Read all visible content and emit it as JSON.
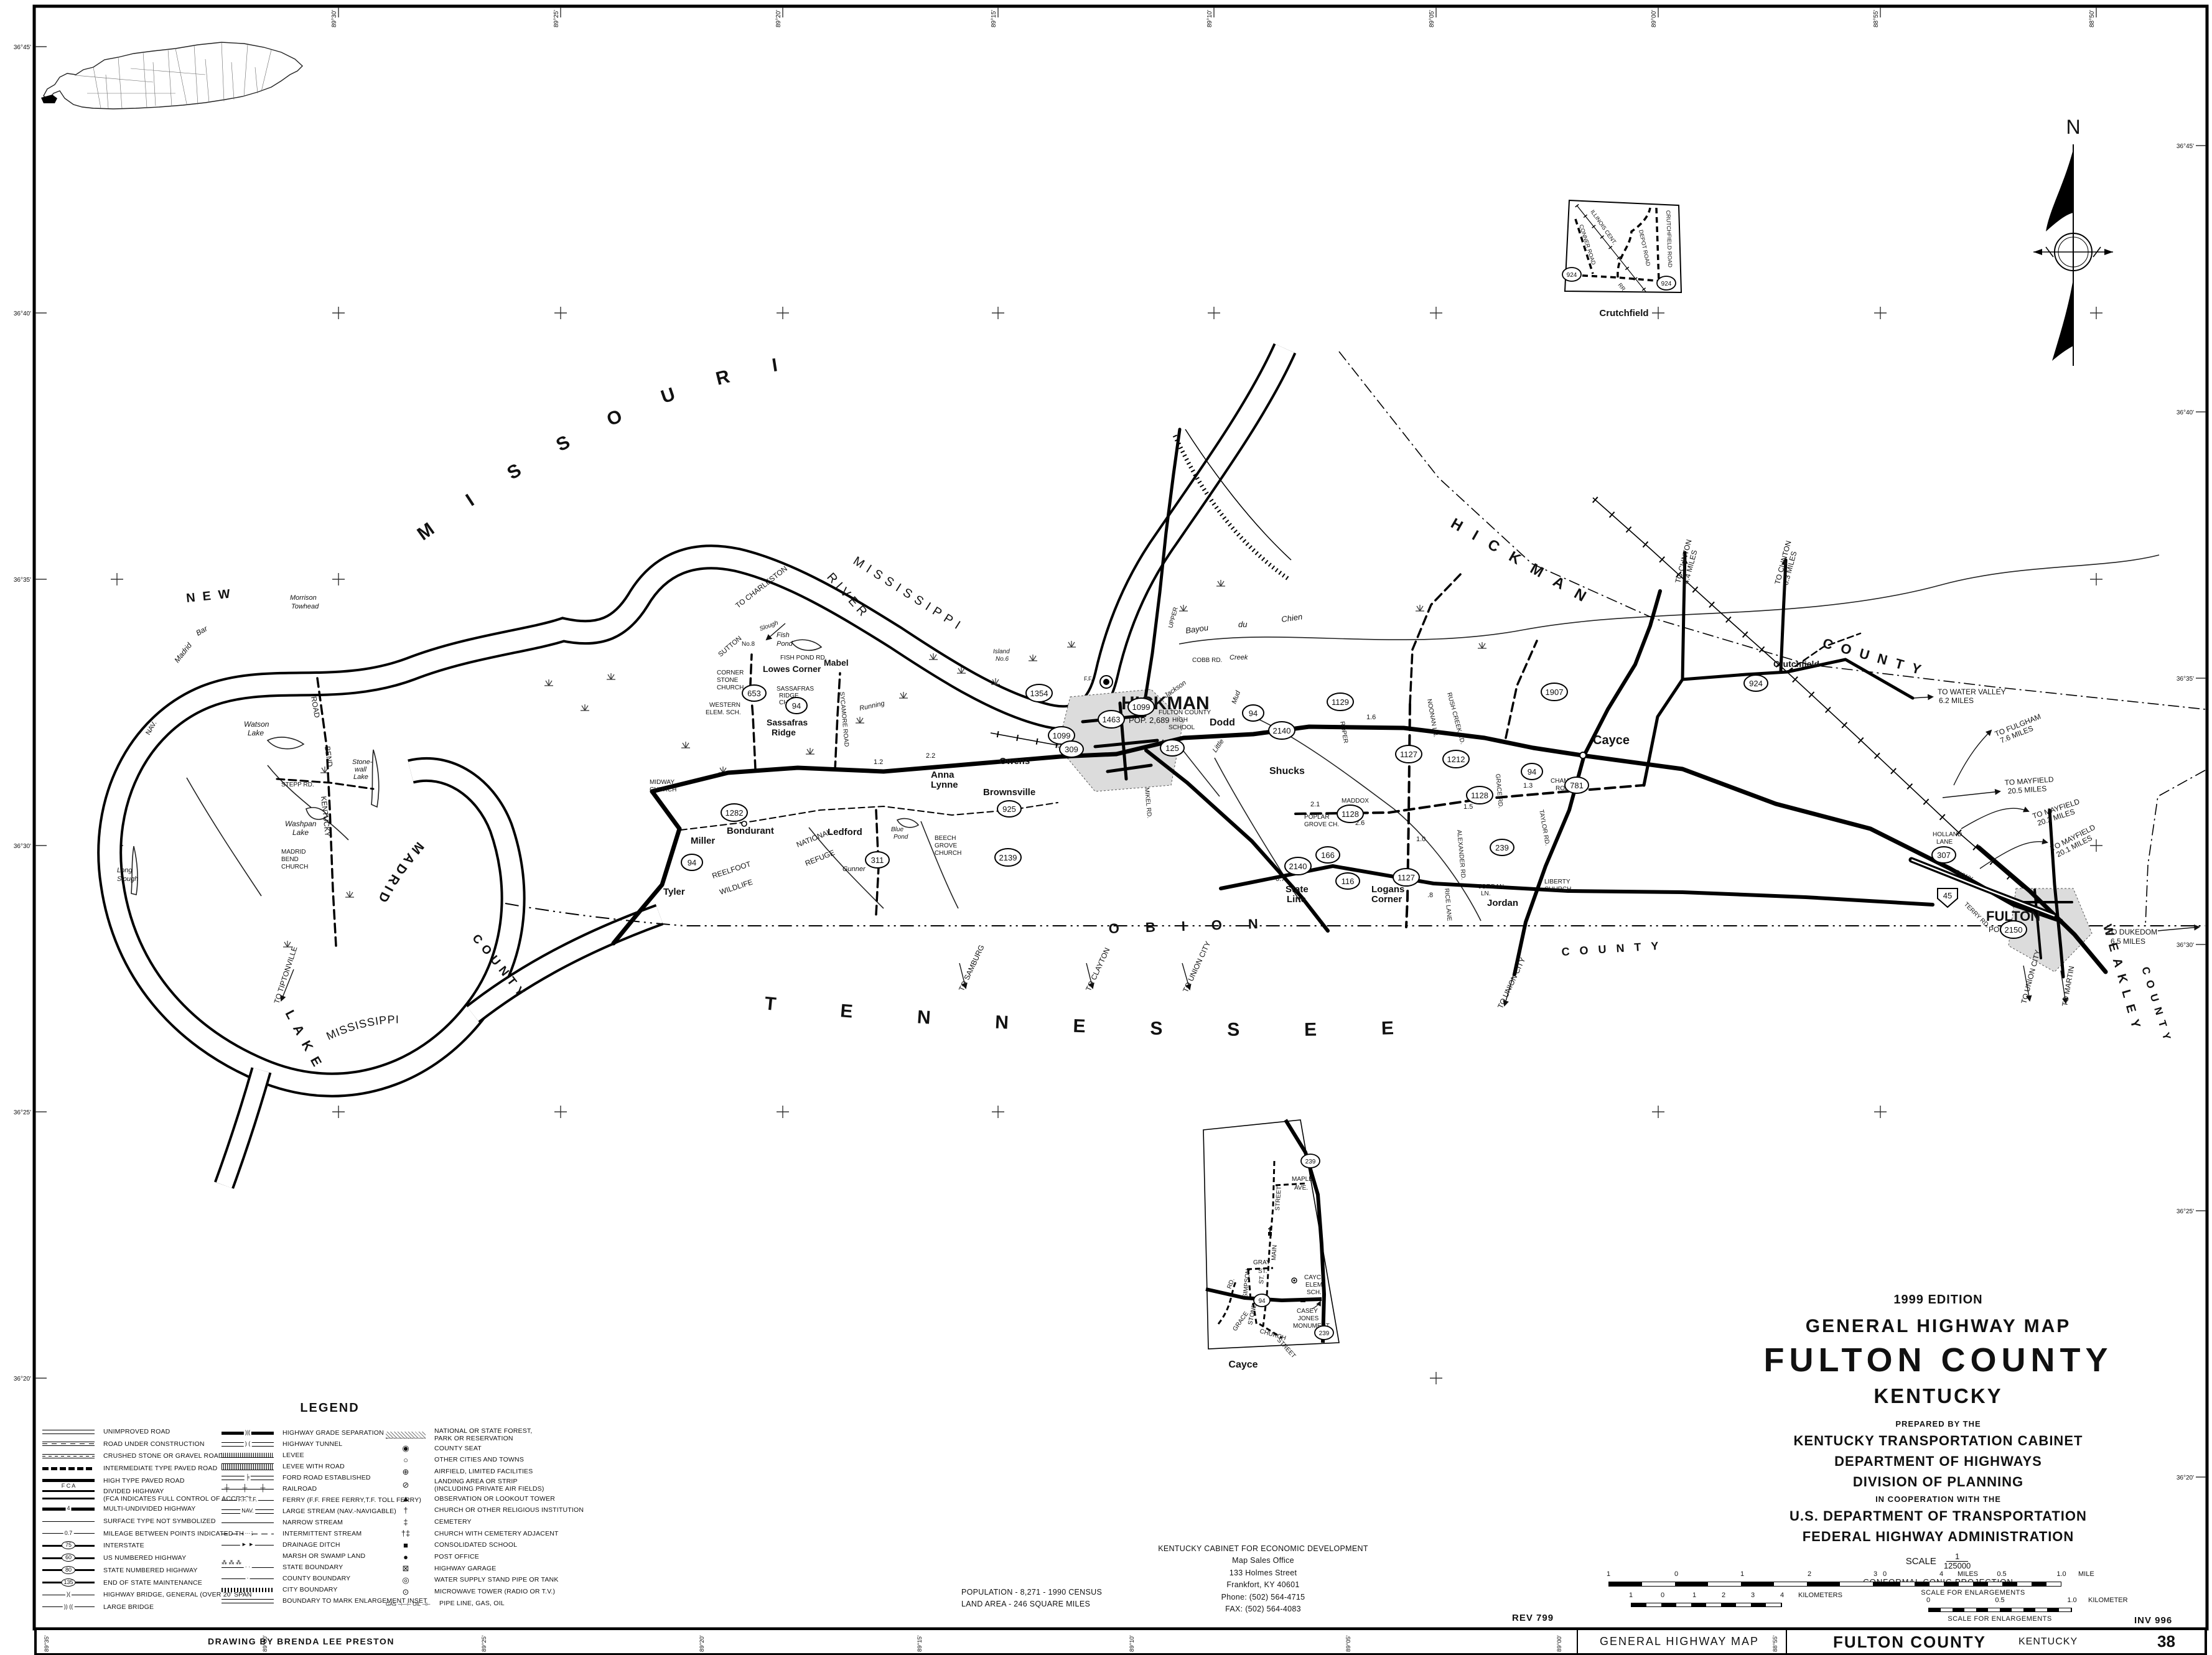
{
  "sheet": {
    "edition": "1999 EDITION",
    "map_type": "GENERAL HIGHWAY MAP",
    "county_title": "FULTON COUNTY",
    "state_title": "KENTUCKY",
    "prepared_by": "PREPARED BY THE",
    "agency1": "KENTUCKY TRANSPORTATION CABINET",
    "agency2": "DEPARTMENT OF HIGHWAYS",
    "agency3": "DIVISION OF PLANNING",
    "coop": "IN COOPERATION WITH THE",
    "agency4": "U.S. DEPARTMENT OF TRANSPORTATION",
    "agency5": "FEDERAL HIGHWAY ADMINISTRATION",
    "scale_label": "SCALE",
    "scale_numerator": "1",
    "scale_denominator": "125000",
    "projection": "CONFORMAL CONIC PROJECTION",
    "rev": "REV 799",
    "inv": "INV 996",
    "credit": "DRAWING BY BRENDA LEE PRESTON",
    "population": "POPULATION - 8,271 - 1990 CENSUS",
    "land_area": "LAND AREA - 246 SQUARE MILES",
    "office": [
      "KENTUCKY CABINET FOR ECONOMIC DEVELOPMENT",
      "Map Sales Office",
      "133 Holmes Street",
      "Frankfort, KY  40601",
      "Phone: (502) 564-4715",
      "FAX: (502) 564-4083"
    ]
  },
  "bars": {
    "miles_ticks": [
      "1",
      "0",
      "1",
      "2",
      "3",
      "4"
    ],
    "miles_unit": "MILES",
    "km_ticks": [
      "1",
      "0",
      "1",
      "2",
      "3",
      "4"
    ],
    "km_unit": "KILOMETERS",
    "enl_mile_ticks": [
      "0",
      "0.5",
      "1.0"
    ],
    "enl_mile_unit": "MILE",
    "enl_km_ticks": [
      "0",
      "0.5",
      "1.0"
    ],
    "enl_km_unit": "KILOMETER",
    "enl_caption": "SCALE FOR ENLARGEMENTS"
  },
  "bottom_bar": {
    "left_label": "GENERAL HIGHWAY MAP",
    "county": "FULTON COUNTY",
    "state": "KENTUCKY",
    "sheet_no": "38",
    "divider_tick": "88°55'"
  },
  "border": {
    "top": [
      "89°30'",
      "89°25'",
      "89°20'",
      "89°15'",
      "89°10'",
      "89°05'",
      "89°00'",
      "88°55'",
      "88°50'"
    ],
    "bottom": [
      "89°35'",
      "89°30'",
      "89°25'",
      "89°20'",
      "89°15'",
      "89°10'",
      "89°05'",
      "89°00'"
    ],
    "left": [
      "36°45'",
      "36°40'",
      "36°35'",
      "36°30'",
      "36°25'",
      "36°20'"
    ],
    "right": [
      "36°45'",
      "36°40'",
      "36°35'",
      "36°30'",
      "36°25'",
      "36°20'"
    ]
  },
  "compass": {
    "n": "N"
  },
  "legend": {
    "title": "LEGEND",
    "col1": [
      {
        "symc": "ls l-unimproved",
        "label": "UNIMPROVED ROAD"
      },
      {
        "symc": "ls l-construction",
        "label": "ROAD UNDER CONSTRUCTION"
      },
      {
        "symc": "ls l-gravel",
        "label": "CRUSHED STONE OR GRAVEL ROAD"
      },
      {
        "symc": "ls l-intermediate",
        "label": "INTERMEDIATE TYPE PAVED ROAD"
      },
      {
        "symc": "ls l-high",
        "label": "HIGH TYPE PAVED ROAD"
      },
      {
        "symc": "ls l-divided",
        "sym_text": "F C A",
        "label": "DIVIDED HIGHWAY\n(FCA INDICATES FULL CONTROL OF ACCESS)"
      },
      {
        "symc": "ls l-multi",
        "sym_text": "4",
        "label": "MULTI-UNDIVIDED HIGHWAY"
      },
      {
        "symc": "ls l-thin",
        "label": "SURFACE TYPE NOT SYMBOLIZED"
      },
      {
        "symc": "ls l-thin",
        "sym_text": "0.7",
        "label": "MILEAGE BETWEEN POINTS INDICATED THUS"
      },
      {
        "symc": "ls l-shield",
        "sym_text": "75",
        "label": "INTERSTATE"
      },
      {
        "symc": "ls l-shield",
        "sym_text": "60",
        "label": "US NUMBERED HIGHWAY"
      },
      {
        "symc": "ls l-shield",
        "sym_text": "80",
        "label": "STATE NUMBERED HIGHWAY"
      },
      {
        "symc": "ls l-shield",
        "sym_text": "135",
        "label": "END OF STATE MAINTENANCE"
      },
      {
        "symc": "ls l-thin",
        "sym_text": ")(",
        "label": "HIGHWAY BRIDGE, GENERAL (OVER 20' SPAN"
      },
      {
        "symc": "ls l-thin",
        "sym_text": ")) ((",
        "label": "LARGE BRIDGE"
      }
    ],
    "col2": [
      {
        "symc": "ls l-high",
        "sym_text": ")|(",
        "label": "HIGHWAY GRADE SEPARATION"
      },
      {
        "symc": "ls l-unimproved",
        "sym_text": ") (",
        "label": "HIGHWAY TUNNEL"
      },
      {
        "symc": "ls l-levee",
        "label": "LEVEE"
      },
      {
        "symc": "ls l-leveeroad",
        "label": "LEVEE WITH ROAD"
      },
      {
        "symc": "ls l-unimproved",
        "sym_text": "╞",
        "label": "FORD ROAD ESTABLISHED"
      },
      {
        "symc": "ls l-rail",
        "sym_text": "┼  ┼  ┼",
        "label": "RAILROAD"
      },
      {
        "symc": "ls l-thin",
        "sym_text": "F.F.  T.F.",
        "label": "FERRY (F.F. FREE FERRY,T.F. TOLL FERRY)"
      },
      {
        "symc": "ls l-unimproved",
        "sym_text": "NAV.",
        "label": "LARGE STREAM (NAV.-NAVIGABLE)"
      },
      {
        "symc": "ls l-thin",
        "label": "NARROW STREAM"
      },
      {
        "symc": "ls l-dashdotted",
        "sym_text": "···",
        "label": "INTERMITTENT STREAM"
      },
      {
        "symc": "ls l-thin",
        "sym_text": "► ►",
        "label": "DRAINAGE DITCH"
      },
      {
        "symc": "ls l-none",
        "sym_text": "⁂ ⁂ ⁂",
        "label": "MARSH OR SWAMP LAND"
      },
      {
        "symc": "ls l-thin",
        "sym_text": "· ·",
        "label": "STATE BOUNDARY"
      },
      {
        "symc": "ls l-thin",
        "sym_text": "·",
        "label": "COUNTY BOUNDARY"
      },
      {
        "symc": "ls l-city",
        "label": "CITY BOUNDARY"
      },
      {
        "symc": "ls l-unimproved",
        "label": "BOUNDARY TO MARK ENLARGEMENT INSET"
      }
    ],
    "col3": [
      {
        "symc": "ls l-forest",
        "label": "NATIONAL OR STATE FOREST,\nPARK OR RESERVATION"
      },
      {
        "symc": "pt",
        "sym_text": "◉",
        "label": "COUNTY SEAT"
      },
      {
        "symc": "pt",
        "sym_text": "○",
        "label": "OTHER CITIES AND TOWNS"
      },
      {
        "symc": "pt",
        "sym_text": "⊕",
        "label": "AIRFIELD, LIMITED FACILITIES"
      },
      {
        "symc": "pt",
        "sym_text": "⊘",
        "label": "LANDING AREA OR STRIP\n(INCLUDING PRIVATE AIR FIELDS)"
      },
      {
        "symc": "pt",
        "sym_text": "▲",
        "label": "OBSERVATION OR LOOKOUT TOWER"
      },
      {
        "symc": "pt",
        "sym_text": "†",
        "label": "CHURCH OR OTHER RELIGIOUS INSTITUTION"
      },
      {
        "symc": "pt",
        "sym_text": "‡",
        "label": "CEMETERY"
      },
      {
        "symc": "pt",
        "sym_text": "†‡",
        "label": "CHURCH WITH CEMETERY ADJACENT"
      },
      {
        "symc": "pt",
        "sym_text": "■",
        "label": "CONSOLIDATED SCHOOL"
      },
      {
        "symc": "pt",
        "sym_text": "●",
        "label": "POST OFFICE"
      },
      {
        "symc": "pt",
        "sym_text": "⊠",
        "label": "HIGHWAY GARAGE"
      },
      {
        "symc": "pt",
        "sym_text": "◎",
        "label": "WATER SUPPLY STAND PIPE OR TANK"
      },
      {
        "symc": "pt",
        "sym_text": "⊙",
        "label": "MICROWAVE TOWER (RADIO OR T.V.)"
      },
      {
        "symc": "pt sm",
        "sym_text": "GAS ⊣—⊢ OIL ⊣⊢",
        "label": "PIPE LINE, GAS, OIL"
      }
    ]
  },
  "regions": {
    "missouri": "MISSOURI",
    "mississippi": "MISSISSIPPI",
    "river": "RIVER",
    "new": "NEW",
    "madrid": "MADRID",
    "county": "COUNTY",
    "lake": "LAKE",
    "tennessee": "TENNESSEE",
    "obion": "OBION",
    "hickman_co": "HICKMAN",
    "weakley": "WEAKLEY",
    "kentucky_bend_1": "KENTUCKY",
    "kentucky_bend_2": "BEND",
    "kentucky_bend_3": "ROAD",
    "reelfoot_1": "REELFOOT",
    "reelfoot_2": "WILDLIFE",
    "refuge_1": "NATIONAL",
    "refuge_2": "REFUGE",
    "nav": "NAV."
  },
  "towns": {
    "hickman": "HICKMAN",
    "hickman_pop": "POP. 2,689",
    "fulton": "FULTON",
    "fulton_pop": "POP. 3,078",
    "cayce": "Cayce",
    "dodd": "Dodd",
    "shucks": "Shucks",
    "state_line_1": "State",
    "state_line_2": "Line",
    "logans_1": "Logans",
    "logans_2": "Corner",
    "jordan": "Jordan",
    "miller": "Miller",
    "tyler": "Tyler",
    "bondurant": "Bondurant",
    "ledford": "Ledford",
    "anna_1": "Anna",
    "anna_2": "Lynne",
    "brownsville": "Brownsville",
    "owens": "Owens",
    "sassafras_1": "Sassafras",
    "sassafras_2": "Ridge",
    "lowes": "Lowes Corner",
    "mabel": "Mabel",
    "crutchfield": "Crutchfield",
    "western_1": "WESTERN",
    "western_2": "ELEM. SCH.",
    "corner_stone_1": "CORNER",
    "corner_stone_2": "STONE",
    "corner_stone_3": "CHURCH",
    "sr_church_1": "SASSAFRAS",
    "sr_church_2": "RIDGE",
    "sr_church_3": "CHURCH",
    "fchs_1": "FULTON COUNTY",
    "fchs_2": "HIGH",
    "fchs_3": "SCHOOL",
    "midway_1": "MIDWAY",
    "midway_2": "CHURCH",
    "beech_1": "BEECH",
    "beech_2": "GROVE",
    "beech_3": "CHURCH",
    "liberty_1": "LIBERTY",
    "liberty_2": "CHURCH",
    "poplar_1": "POPLAR",
    "poplar_2": "GROVE CH.",
    "mbc_1": "MADRID",
    "mbc_2": "BEND",
    "mbc_3": "CHURCH"
  },
  "waters": {
    "morrison_1": "Morrison",
    "morrison_2": "Towhead",
    "madrid_bar_1": "Madrid",
    "madrid_bar_2": "Bar",
    "watson_1": "Watson",
    "watson_2": "Lake",
    "stonewall_1": "Stone-",
    "stonewall_2": "wall",
    "stonewall_3": "Lake",
    "washpan_1": "Washpan",
    "washpan_2": "Lake",
    "long_slough_1": "Long",
    "long_slough_2": "Slough",
    "fish_pond_1": "Fish",
    "fish_pond_2": "Pond",
    "island6_1": "Island",
    "island6_2": "No.6",
    "island8": "No.8",
    "sutton": "SUTTON",
    "bayou": "Bayou",
    "du": "du",
    "chien": "Chien",
    "creek": "Creek",
    "mud": "Mud",
    "little": "Little",
    "jackson": "Jackson",
    "gunner": "Gunner",
    "blue_1": "Blue",
    "blue_2": "Pond",
    "running": "Running",
    "slough": "Slough"
  },
  "roads": {
    "stepp": "STEPP  RD.",
    "cobb": "COBB  RD.",
    "upper": "UPPER",
    "grace": "GRACE RD.",
    "maddox_1": "MADDOX",
    "maddox_2": "RD.",
    "champion_1": "CHAMPION",
    "champion_2": "ROAD",
    "jordan_ln_1": "JORDAN",
    "jordan_ln_2": "LN.",
    "taylor": "TAYLOR RD.",
    "alexander": "ALEXANDER RD.",
    "rice": "RICE LANE",
    "roper": "ROPER",
    "noonan": "NOONAN LN.",
    "rush": "RUSH CREEK RD.",
    "holland_1": "HOLLAND",
    "holland_2": "LANE",
    "pkwy": "PKWY.",
    "terry": "TERRY RD.",
    "mikel": "MIKEL RD.",
    "sycamore": "SYCAMORE ROAD",
    "fishpond_rd": "FISH POND RD.",
    "ff": "F.F."
  },
  "mileages": {
    "m22": "2.2",
    "m12": "1.2",
    "m16": "1.6",
    "m21": "2.1",
    "m26": "2.6",
    "m15": "1.5",
    "m10": "1.0",
    "m07": "0.7",
    "m13": "1.3",
    "m08": ".8",
    "m44": ".4"
  },
  "to": {
    "charleston": "TO CHARLESTON",
    "clinton44_1": "TO CLINTON",
    "clinton44_2": "4.4 MILES",
    "clinton63_1": "TO CLINTON",
    "clinton63_2": "6.3 MILES",
    "water_valley_1": "TO WATER VALLEY",
    "water_valley_2": "6.2 MILES",
    "fulgham_1": "TO FULGHAM",
    "fulgham_2": "7.6 MILES",
    "mayfield205_1": "TO MAYFIELD",
    "mayfield205_2": "20.5 MILES",
    "mayfield202_1": "TO MAYFIELD",
    "mayfield202_2": "20.2 MILES",
    "mayfield201_1": "TO MAYFIELD",
    "mayfield201_2": "20.1 MILES",
    "dukedom_1": "TO DUKEDOM",
    "dukedom_2": "6.5 MILES",
    "martin": "TO MARTIN",
    "union_city": "TO UNION CITY",
    "samburg": "TO SAMBURG",
    "clayton": "TO CLAYTON",
    "tiptonville": "TO TIPTONVILLE"
  },
  "shields": {
    "s94": "94",
    "s125": "125",
    "s239": "239",
    "s1099": "1099",
    "s1354": "1354",
    "s1463": "1463",
    "s309": "309",
    "s653": "653",
    "s924": "924",
    "s1127": "1127",
    "s1128": "1128",
    "s1129": "1129",
    "s1212": "1212",
    "s2140": "2140",
    "s166": "166",
    "s116": "116",
    "s311": "311",
    "s925": "925",
    "s2139": "2139",
    "s1282": "1282",
    "s2150": "2150",
    "s307": "307",
    "s781": "781",
    "s1907": "1907",
    "s45": "45"
  },
  "insets": {
    "crutchfield": {
      "caption": "Crutchfield",
      "illinois": "ILLINOIS CENT.",
      "conner": "CONNER ROAD",
      "depot": "DEPOT ROAD",
      "crutch_rd": "CRUTCHFIELD ROAD",
      "rr": "RR"
    },
    "cayce": {
      "caption": "Cayce",
      "maple_1": "MAPLE",
      "maple_2": "AVE.",
      "main": "MAIN",
      "street": "STREET",
      "gray_1": "GRAY",
      "gray_2": "ST.",
      "simpson": "SIMPSON",
      "st": "ST.",
      "stone": "STONE",
      "church": "CHURCH",
      "street2": "STREET",
      "grace_1": "GRACE",
      "grace_2": "RD.",
      "elem_1": "CAYCE",
      "elem_2": "ELEM.",
      "elem_3": "SCH.",
      "casey_1": "CASEY",
      "casey_2": "JONES",
      "casey_3": "MONUMENT"
    }
  }
}
